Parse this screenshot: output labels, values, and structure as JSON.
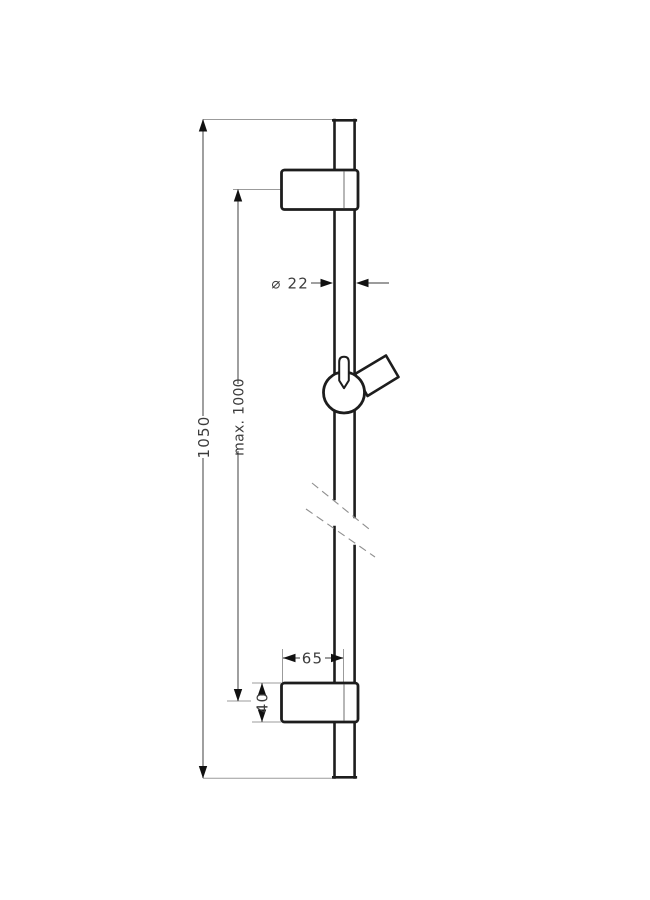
{
  "drawing": {
    "title": "shower-slide-bar-technical-drawing",
    "colors": {
      "outline": "#1d1d1d",
      "dimension_line": "#606060",
      "extension_line": "#9b9b9b",
      "arrow": "#111111",
      "label_text": "#3c3c3c",
      "fill": "#ffffff"
    },
    "labels": {
      "overall_height": "1050",
      "max_slider_travel": "max. 1000",
      "bar_diameter": "⌀ 22",
      "bracket_offset": "65",
      "bracket_height": "40"
    }
  }
}
